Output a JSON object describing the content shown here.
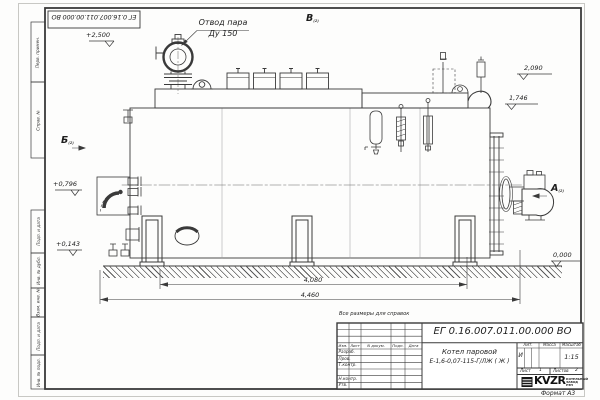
{
  "sheet": {
    "doc_number_top": "ЕГ 0.16.007.011.00.000 ВО",
    "format_note": "Формат А3",
    "reference_note": "Все размеры для справок",
    "border_labels": {
      "perv_primen": "Перв. примен.",
      "sprav_no": "Справ. №",
      "podp_data_1": "Подп. и дата",
      "inv_dubl": "Инв. № дубл.",
      "vzam_inv": "Взам. инв. №",
      "podp_data_2": "Подп. и дата",
      "inv_podl": "Инв. № подл."
    }
  },
  "drawing": {
    "callouts": {
      "steam_outlet_line1": "Отвод пара",
      "steam_outlet_line2": "Ду 150"
    },
    "view_marks": {
      "top": "В",
      "left": "Б",
      "right": "А",
      "ref": "(2)"
    },
    "elevations": {
      "steam_valve": "+2,500",
      "safety_valve": "2,090",
      "drum_top": "1,746",
      "burner_axis": "+0,796",
      "manhole": "+0,143",
      "ground": "0,000"
    },
    "dimensions": {
      "boiler_length": "4,080",
      "overall_length": "4,460"
    }
  },
  "title_block": {
    "doc_number": "ЕГ 0.16.007.011.00.000 ВО",
    "product_name_line1": "Котел паровой",
    "product_name_line2": "Е-1,6-0,07-115-Г/ЛЖ ( Ж )",
    "header_cols": {
      "izm": "Изм.",
      "list": "Лист",
      "n_dokum": "N докум.",
      "podp": "Подп.",
      "data": "Дата"
    },
    "rows": {
      "razrab": "Разраб.",
      "prov": "Пров.",
      "t_kontr": "Т.контр.",
      "n_kontr": "Н.контр.",
      "utv": "Утв."
    },
    "lit_header": "Лит.",
    "mass_header": "Масса",
    "scale_header": "Масштаб",
    "lit_value": "И",
    "scale_value": "1:15",
    "sheet_label": "Лист",
    "sheet_value": "1",
    "sheets_label": "Листов",
    "sheets_value": "2",
    "logo_text": "KVZR",
    "logo_sub_line1": "КОТЕЛЬНЫЙ",
    "logo_sub_line2": "ЗАВОД РЭП"
  }
}
